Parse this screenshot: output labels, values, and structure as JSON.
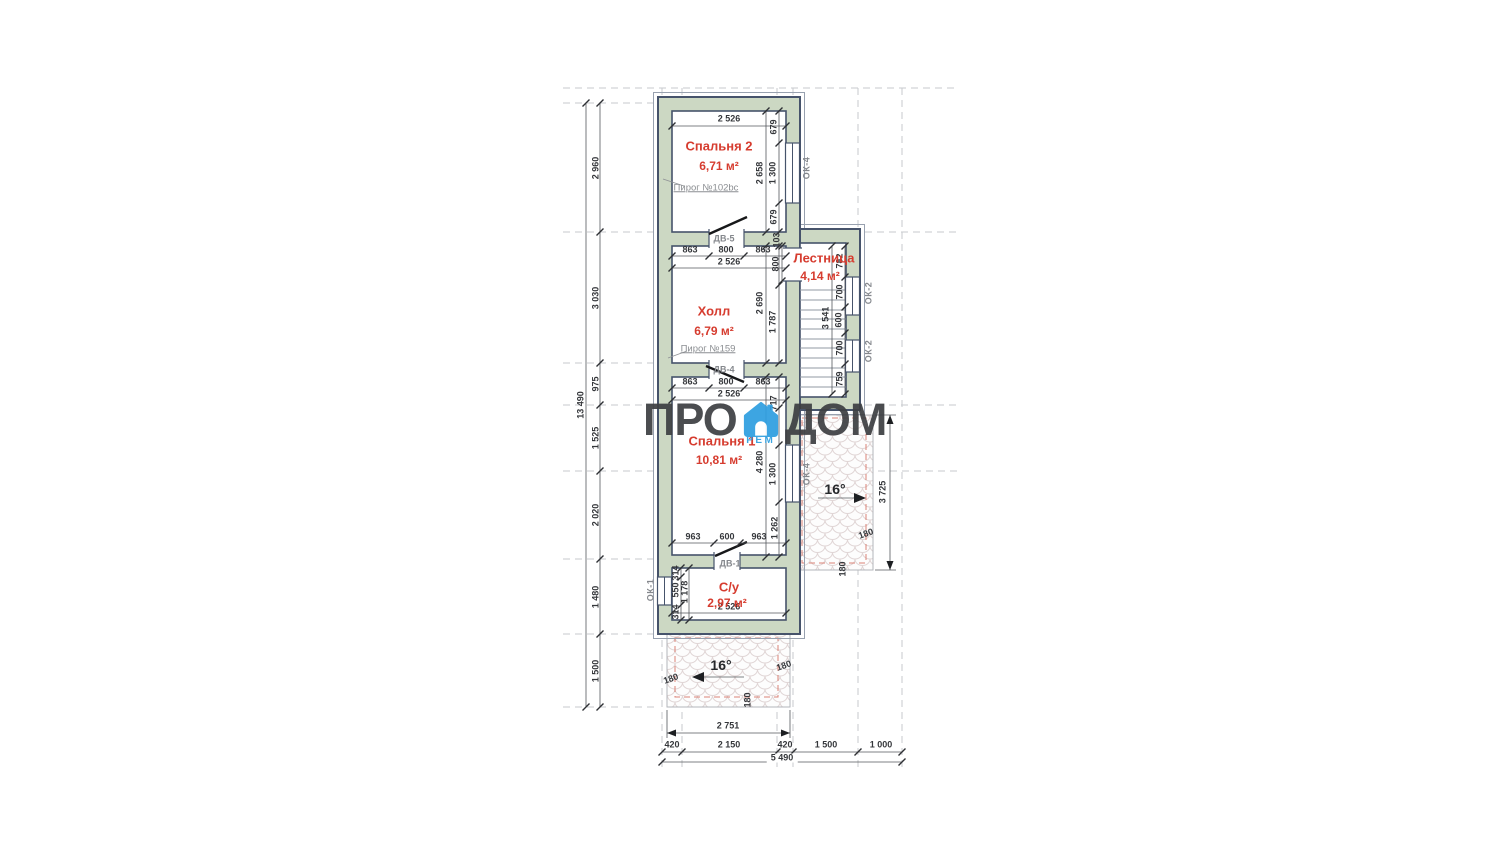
{
  "logo": {
    "left": "ПРО",
    "right": "ДОМ",
    "sub": "РЕМ",
    "accent": "#2f9fe0",
    "text_color": "#3e4043"
  },
  "colors": {
    "wall_fill": "#ccd8c3",
    "wall_line": "#46536b",
    "room_label": "#d63c2f",
    "eave_dashed": "#da8276"
  },
  "rooms": [
    {
      "name": "Спальня 2",
      "area": "6,71 м²"
    },
    {
      "name": "Холл",
      "area": "6,79 м²"
    },
    {
      "name": "Лестница",
      "area": "4,14 м²"
    },
    {
      "name": "Спальня 1",
      "area": "10,81 м²"
    },
    {
      "name": "С/у",
      "area": "2,97 м²"
    }
  ],
  "annotations": [
    {
      "text": "2 526",
      "x": 729,
      "y": 119,
      "cls": "dim",
      "name": "dimension-label"
    },
    {
      "text": "863",
      "x": 690,
      "y": 250,
      "cls": "dim",
      "name": "dimension-label"
    },
    {
      "text": "800",
      "x": 726,
      "y": 250,
      "cls": "dim",
      "name": "dimension-label"
    },
    {
      "text": "863",
      "x": 763,
      "y": 250,
      "cls": "dim",
      "name": "dimension-label"
    },
    {
      "text": "2 526",
      "x": 729,
      "y": 262,
      "cls": "dim",
      "name": "dimension-label"
    },
    {
      "text": "863",
      "x": 690,
      "y": 382,
      "cls": "dim",
      "name": "dimension-label"
    },
    {
      "text": "800",
      "x": 726,
      "y": 382,
      "cls": "dim",
      "name": "dimension-label"
    },
    {
      "text": "863",
      "x": 763,
      "y": 382,
      "cls": "dim",
      "name": "dimension-label"
    },
    {
      "text": "2 526",
      "x": 729,
      "y": 394,
      "cls": "dim",
      "name": "dimension-label"
    },
    {
      "text": "963",
      "x": 693,
      "y": 537,
      "cls": "dim",
      "name": "dimension-label"
    },
    {
      "text": "600",
      "x": 727,
      "y": 537,
      "cls": "dim",
      "name": "dimension-label"
    },
    {
      "text": "963",
      "x": 759,
      "y": 537,
      "cls": "dim",
      "name": "dimension-label"
    },
    {
      "text": "2 526",
      "x": 729,
      "y": 607,
      "cls": "dim",
      "name": "dimension-label"
    },
    {
      "text": "2 751",
      "x": 728,
      "y": 726,
      "cls": "dim",
      "name": "dimension-label"
    },
    {
      "text": "420",
      "x": 672,
      "y": 745,
      "cls": "dim",
      "name": "dimension-label"
    },
    {
      "text": "2 150",
      "x": 729,
      "y": 745,
      "cls": "dim",
      "name": "dimension-label"
    },
    {
      "text": "420",
      "x": 785,
      "y": 745,
      "cls": "dim",
      "name": "dimension-label"
    },
    {
      "text": "1 500",
      "x": 826,
      "y": 745,
      "cls": "dim",
      "name": "dimension-label"
    },
    {
      "text": "1 000",
      "x": 881,
      "y": 745,
      "cls": "dim",
      "name": "dimension-label"
    },
    {
      "text": "5 490",
      "x": 782,
      "y": 758,
      "cls": "dim-bg",
      "name": "dimension-total-label"
    },
    {
      "text": "679",
      "x": 774,
      "y": 127,
      "rot": -90,
      "cls": "dim-v",
      "name": "dimension-label"
    },
    {
      "text": "2 658",
      "x": 760,
      "y": 173,
      "rot": -90,
      "cls": "dim-v",
      "name": "dimension-label"
    },
    {
      "text": "1 300",
      "x": 773,
      "y": 173,
      "rot": -90,
      "cls": "dim-v",
      "name": "dimension-label"
    },
    {
      "text": "679",
      "x": 774,
      "y": 217,
      "rot": -90,
      "cls": "dim-v",
      "name": "dimension-label"
    },
    {
      "text": "103",
      "x": 777,
      "y": 240,
      "rot": -90,
      "cls": "dim-v",
      "name": "dimension-label"
    },
    {
      "text": "800",
      "x": 776,
      "y": 264,
      "rot": -90,
      "cls": "dim-v",
      "name": "dimension-label"
    },
    {
      "text": "2 690",
      "x": 760,
      "y": 303,
      "rot": -90,
      "cls": "dim-v",
      "name": "dimension-label"
    },
    {
      "text": "1 787",
      "x": 773,
      "y": 322,
      "rot": -90,
      "cls": "dim-v",
      "name": "dimension-label"
    },
    {
      "text": "717",
      "x": 774,
      "y": 403,
      "rot": -90,
      "cls": "dim-v",
      "name": "dimension-label"
    },
    {
      "text": "4 280",
      "x": 760,
      "y": 462,
      "rot": -90,
      "cls": "dim-v",
      "name": "dimension-label"
    },
    {
      "text": "1 300",
      "x": 773,
      "y": 474,
      "rot": -90,
      "cls": "dim-v",
      "name": "dimension-label"
    },
    {
      "text": "1 262",
      "x": 775,
      "y": 528,
      "rot": -90,
      "cls": "dim-v",
      "name": "dimension-label"
    },
    {
      "text": "314",
      "x": 676,
      "y": 573,
      "rot": -90,
      "cls": "dim-v",
      "name": "dimension-label"
    },
    {
      "text": "550",
      "x": 676,
      "y": 590,
      "rot": -90,
      "cls": "dim-v",
      "name": "dimension-label"
    },
    {
      "text": "1 178",
      "x": 685,
      "y": 592,
      "rot": -90,
      "cls": "dim-v",
      "name": "dimension-label"
    },
    {
      "text": "314",
      "x": 676,
      "y": 612,
      "rot": -90,
      "cls": "dim-v",
      "name": "dimension-label"
    },
    {
      "text": "13 490",
      "x": 581,
      "y": 405,
      "rot": -90,
      "cls": "dim-v",
      "name": "dimension-total-label"
    },
    {
      "text": "2 960",
      "x": 596,
      "y": 168,
      "rot": -90,
      "cls": "dim-v",
      "name": "dimension-label"
    },
    {
      "text": "3 030",
      "x": 596,
      "y": 298,
      "rot": -90,
      "cls": "dim-v",
      "name": "dimension-label"
    },
    {
      "text": "975",
      "x": 596,
      "y": 384,
      "rot": -90,
      "cls": "dim-v",
      "name": "dimension-label"
    },
    {
      "text": "1 525",
      "x": 596,
      "y": 438,
      "rot": -90,
      "cls": "dim-v",
      "name": "dimension-label"
    },
    {
      "text": "2 020",
      "x": 596,
      "y": 515,
      "rot": -90,
      "cls": "dim-v",
      "name": "dimension-label"
    },
    {
      "text": "1 480",
      "x": 596,
      "y": 597,
      "rot": -90,
      "cls": "dim-v",
      "name": "dimension-label"
    },
    {
      "text": "1 500",
      "x": 596,
      "y": 671,
      "rot": -90,
      "cls": "dim-v",
      "name": "dimension-label"
    },
    {
      "text": "782",
      "x": 840,
      "y": 261,
      "rot": -90,
      "cls": "dim-v",
      "name": "dimension-label"
    },
    {
      "text": "700",
      "x": 840,
      "y": 292,
      "rot": -90,
      "cls": "dim-v",
      "name": "dimension-label"
    },
    {
      "text": "3 541",
      "x": 826,
      "y": 318,
      "rot": -90,
      "cls": "dim-v",
      "name": "dimension-label"
    },
    {
      "text": "600",
      "x": 839,
      "y": 320,
      "rot": -90,
      "cls": "dim-v",
      "name": "dimension-label"
    },
    {
      "text": "700",
      "x": 840,
      "y": 348,
      "rot": -90,
      "cls": "dim-v",
      "name": "dimension-label"
    },
    {
      "text": "759",
      "x": 840,
      "y": 379,
      "rot": -90,
      "cls": "dim-v",
      "name": "dimension-label"
    },
    {
      "text": "3 725",
      "x": 883,
      "y": 492,
      "rot": -90,
      "cls": "dim-v",
      "name": "dimension-label"
    },
    {
      "text": "180",
      "x": 866,
      "y": 534,
      "rot": -20,
      "cls": "dim",
      "name": "overhang-label"
    },
    {
      "text": "180",
      "x": 843,
      "y": 569,
      "rot": -90,
      "cls": "dim",
      "name": "overhang-label"
    },
    {
      "text": "180",
      "x": 671,
      "y": 679,
      "rot": -20,
      "cls": "dim",
      "name": "overhang-label"
    },
    {
      "text": "180",
      "x": 784,
      "y": 666,
      "rot": -20,
      "cls": "dim",
      "name": "overhang-label"
    },
    {
      "text": "180",
      "x": 748,
      "y": 700,
      "rot": -90,
      "cls": "dim",
      "name": "overhang-label"
    },
    {
      "text": "16°",
      "x": 835,
      "y": 489,
      "cls": "deg",
      "name": "roof-slope-label"
    },
    {
      "text": "16°",
      "x": 721,
      "y": 665,
      "cls": "deg",
      "name": "roof-slope-label"
    },
    {
      "text": "Спальня 2",
      "x": 719,
      "y": 146,
      "cls": "room-name",
      "name": "room-name-label"
    },
    {
      "text": "6,71 м²",
      "x": 719,
      "y": 166,
      "cls": "room-area",
      "name": "room-area-label"
    },
    {
      "text": "Холл",
      "x": 714,
      "y": 311,
      "cls": "room-name",
      "name": "room-name-label"
    },
    {
      "text": "6,79 м²",
      "x": 714,
      "y": 331,
      "cls": "room-area",
      "name": "room-area-label"
    },
    {
      "text": "Лестница",
      "x": 824,
      "y": 258,
      "cls": "room-name",
      "name": "room-name-label"
    },
    {
      "text": "4,14 м²",
      "x": 820,
      "y": 276,
      "cls": "room-area",
      "name": "room-area-label"
    },
    {
      "text": "Спальня 1",
      "x": 722,
      "y": 441,
      "cls": "room-name",
      "name": "room-name-label"
    },
    {
      "text": "10,81 м²",
      "x": 719,
      "y": 460,
      "cls": "room-area",
      "name": "room-area-label"
    },
    {
      "text": "С/у",
      "x": 729,
      "y": 587,
      "cls": "room-name",
      "name": "room-name-label"
    },
    {
      "text": "2,97 м²",
      "x": 727,
      "y": 603,
      "cls": "room-area",
      "name": "room-area-label"
    },
    {
      "text": "Пирог №102bc",
      "x": 706,
      "y": 188,
      "cls": "note",
      "name": "note-label"
    },
    {
      "text": "Пирог №159",
      "x": 708,
      "y": 349,
      "cls": "note",
      "name": "note-label"
    },
    {
      "text": "ДВ-5",
      "x": 724,
      "y": 239,
      "cls": "door-label",
      "name": "door-label"
    },
    {
      "text": "ДВ-4",
      "x": 724,
      "y": 370,
      "cls": "door-label",
      "name": "door-label"
    },
    {
      "text": "ДВ-1",
      "x": 730,
      "y": 564,
      "cls": "door-label",
      "name": "door-label"
    },
    {
      "text": "ОК-4",
      "x": 807,
      "y": 168,
      "rot": -90,
      "cls": "window-label",
      "name": "window-label"
    },
    {
      "text": "ОК-2",
      "x": 869,
      "y": 293,
      "rot": -90,
      "cls": "window-label",
      "name": "window-label"
    },
    {
      "text": "ОК-2",
      "x": 869,
      "y": 351,
      "rot": -90,
      "cls": "window-label",
      "name": "window-label"
    },
    {
      "text": "ОК-4",
      "x": 807,
      "y": 474,
      "rot": -90,
      "cls": "window-label",
      "name": "window-label"
    },
    {
      "text": "ОК-1",
      "x": 651,
      "y": 590,
      "rot": -90,
      "cls": "window-label",
      "name": "window-label"
    }
  ]
}
